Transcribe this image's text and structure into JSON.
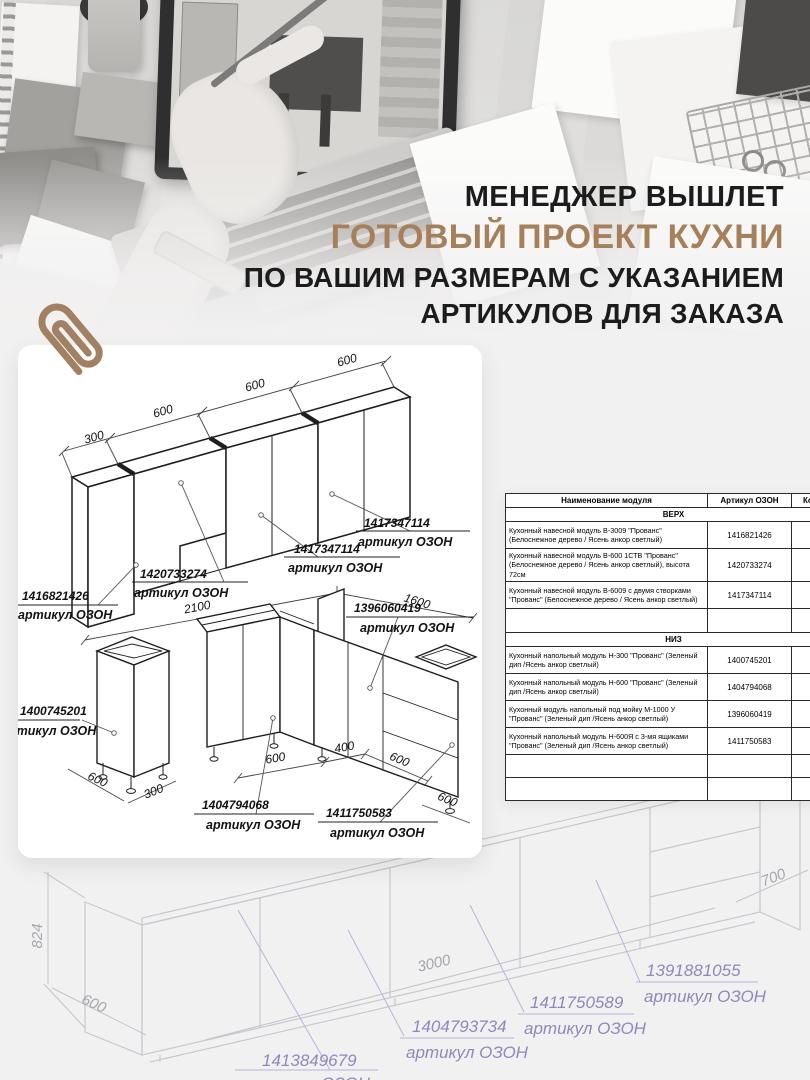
{
  "hero": {
    "line1": "МЕНЕДЖЕР ВЫШЛЕТ",
    "line2": "ГОТОВЫЙ ПРОЕКТ КУХНИ",
    "line3": "ПО ВАШИМ РАЗМЕРАМ С УКАЗАНИЕМ",
    "line4": "АРТИКУЛОВ ДЛЯ ЗАКАЗА",
    "accent_color": "#a5805a"
  },
  "card": {
    "upper": {
      "dims": {
        "d300": "300",
        "d600a": "600",
        "d600b": "600",
        "d600c": "600"
      },
      "labels": {
        "l1": {
          "article": "1416821426",
          "caption": "артикул ОЗОН"
        },
        "l2": {
          "article": "1420733274",
          "caption": "артикул ОЗОН"
        },
        "l3": {
          "article": "1417347114",
          "caption": "артикул ОЗОН"
        },
        "l4": {
          "article": "1417347114",
          "caption": "артикул ОЗОН"
        }
      }
    },
    "lower": {
      "dims": {
        "w2100": "2100",
        "w1600": "1600",
        "cab600": "600",
        "cab300": "300",
        "runA600": "600",
        "runA400": "400",
        "runB600": "600",
        "right600": "600"
      },
      "labels": {
        "sink": {
          "article": "1396060419",
          "caption": "артикул ОЗОН"
        },
        "h300": {
          "article": "1400745201",
          "caption": "артикул ОЗОН"
        },
        "h600": {
          "article": "1404794068",
          "caption": "артикул ОЗОН"
        },
        "drawers": {
          "article": "1411750583",
          "caption": "артикул ОЗОН"
        }
      }
    }
  },
  "table": {
    "headers": [
      "Наименование модуля",
      "Артикул ОЗОН",
      "Кол-во"
    ],
    "sections": [
      {
        "title": "ВЕРХ",
        "rows": [
          {
            "name": "Кухонный навесной модуль В-3009 \"Прованс\" (Белоснежное дерево / Ясень анкор светлый)",
            "article": "1416821426"
          },
          {
            "name": "Кухонный навесной модуль В-600 1СТВ \"Прованс\" (Белоснежное дерево / Ясень анкор светлый), высота 72см",
            "article": "1420733274"
          },
          {
            "name": "Кухонный навесной модуль В-6009 с двумя створками \"Прованс\" (Белоснежное дерево / Ясень анкор светлый)",
            "article": "1417347114"
          }
        ]
      },
      {
        "title": "НИЗ",
        "rows": [
          {
            "name": "Кухонный напольный модуль Н-300 \"Прованс\" (Зеленый дип /Ясень анкор светлый)",
            "article": "1400745201"
          },
          {
            "name": "Кухонный напольный модуль Н-600 \"Прованс\" (Зеленый дип /Ясень анкор светлый)",
            "article": "1404794068"
          },
          {
            "name": "Кухонный модуль напольный под мойку М-1000 У \"Прованс\" (Зеленый дип /Ясень анкор светлый)",
            "article": "1396060419"
          },
          {
            "name": "Кухонный напольный модуль Н-600Я с 3-мя ящиками \"Прованс\" (Зеленый дип /Ясень анкор светлый)",
            "article": "1411750583"
          }
        ]
      }
    ]
  },
  "background_drawing": {
    "dims": {
      "h824": "824",
      "d600": "600",
      "w3000": "3000",
      "w700": "700"
    },
    "labels": {
      "la": {
        "article": "1413849679",
        "caption": "артикул ОЗОН"
      },
      "lb": {
        "article": "1404793734",
        "caption": "артикул ОЗОН"
      },
      "lc": {
        "article": "1411750589",
        "caption": "артикул ОЗОН"
      },
      "ld": {
        "article": "1391881055",
        "caption": "артикул ОЗОН"
      }
    }
  }
}
